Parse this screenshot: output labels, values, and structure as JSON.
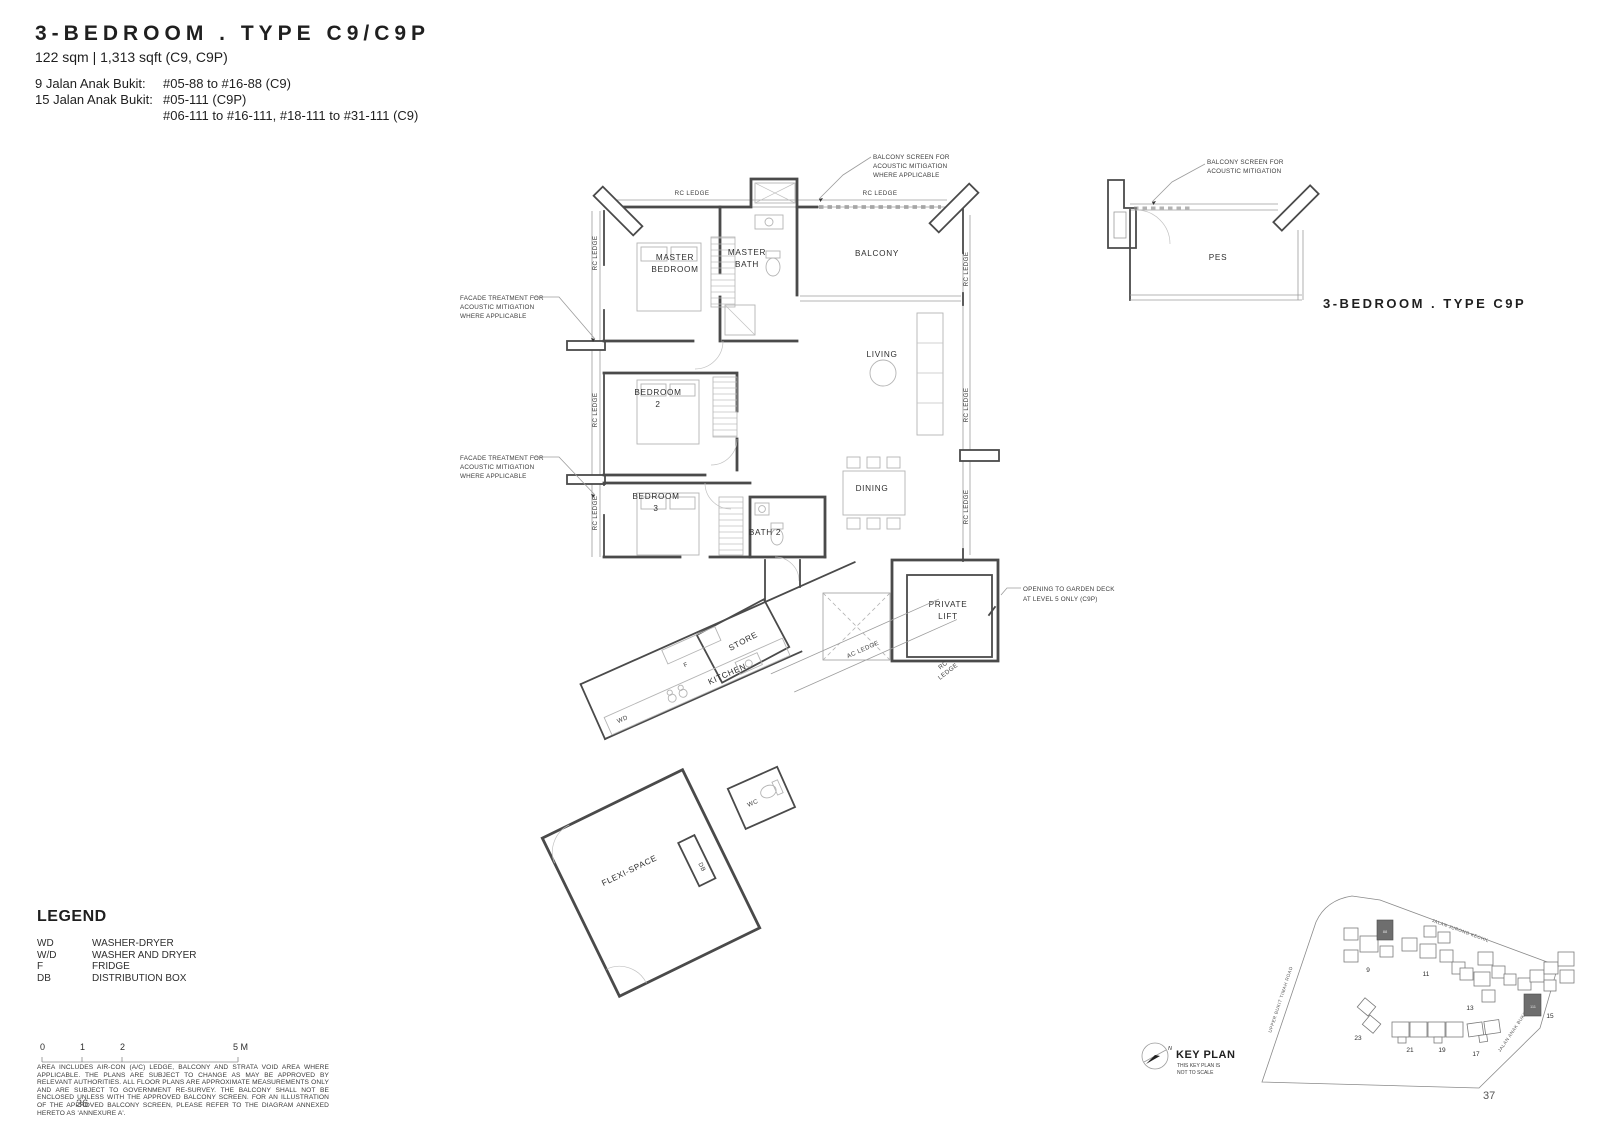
{
  "header": {
    "title": "3-BEDROOM . TYPE C9/C9P",
    "area": "122 sqm | 1,313 sqft (C9, C9P)",
    "addresses": [
      {
        "label": "9 Jalan Anak Bukit:",
        "value": "#05-88 to #16-88 (C9)"
      },
      {
        "label": "15 Jalan Anak Bukit:",
        "value": "#05-111 (C9P)"
      },
      {
        "label": "",
        "value": "#06-111 to #16-111, #18-111 to #31-111 (C9)"
      }
    ]
  },
  "plan": {
    "rooms": {
      "master_bedroom": [
        "MASTER",
        "BEDROOM"
      ],
      "master_bath": [
        "MASTER",
        "BATH"
      ],
      "balcony": "BALCONY",
      "living": "LIVING",
      "bedroom2": [
        "BEDROOM",
        "2"
      ],
      "bedroom3": [
        "BEDROOM",
        "3"
      ],
      "bath2": "BATH 2",
      "dining": "DINING",
      "private_lift": [
        "PRIVATE",
        "LIFT"
      ],
      "store": "STORE",
      "kitchen": "KITCHEN",
      "wc": "WC",
      "flexi_space": "FLEXI-SPACE"
    },
    "fixtures": {
      "wd": "WD",
      "f": "F",
      "db": "DB"
    },
    "ledges": {
      "rc": "RC LEDGE",
      "ac": "AC LEDGE",
      "rc_split": [
        "RC",
        "LEDGE"
      ]
    },
    "notes": {
      "balcony_screen": [
        "BALCONY SCREEN FOR",
        "ACOUSTIC MITIGATION",
        "WHERE APPLICABLE"
      ],
      "facade": [
        "FACADE TREATMENT FOR",
        "ACOUSTIC MITIGATION",
        "WHERE APPLICABLE"
      ],
      "garden_deck": [
        "OPENING TO GARDEN DECK",
        "AT LEVEL 5 ONLY (C9P)"
      ]
    }
  },
  "pes_plan": {
    "room": "PES",
    "note": [
      "BALCONY SCREEN FOR",
      "ACOUSTIC MITIGATION"
    ],
    "type_label": "3-BEDROOM . TYPE C9P"
  },
  "legend": {
    "heading": "LEGEND",
    "items": [
      {
        "abbr": "WD",
        "desc": "WASHER-DRYER"
      },
      {
        "abbr": "W/D",
        "desc": "WASHER AND DRYER"
      },
      {
        "abbr": "F",
        "desc": "FRIDGE"
      },
      {
        "abbr": "DB",
        "desc": "DISTRIBUTION BOX"
      }
    ]
  },
  "scale": {
    "ticks": [
      "0",
      "1",
      "2",
      "5 M"
    ]
  },
  "disclaimer": "AREA INCLUDES AIR-CON (A/C) LEDGE, BALCONY AND STRATA VOID AREA WHERE APPLICABLE. THE PLANS ARE SUBJECT TO CHANGE AS MAY BE APPROVED BY RELEVANT AUTHORITIES. ALL FLOOR PLANS ARE APPROXIMATE MEASUREMENTS ONLY AND ARE SUBJECT TO GOVERNMENT RE-SURVEY. THE BALCONY SHALL NOT BE ENCLOSED UNLESS WITH THE APPROVED BALCONY SCREEN. FOR AN ILLUSTRATION OF THE APPROVED BALCONY SCREEN, PLEASE REFER TO THE DIAGRAM ANNEXED HERETO AS 'ANNEXURE A'.",
  "key_plan": {
    "title": "KEY PLAN",
    "note": [
      "THIS KEY PLAN IS",
      "NOT TO SCALE"
    ],
    "roads": [
      "JALAN JURONG KECHIL",
      "UPPER BUKIT TIMAH ROAD",
      "JALAN ANAK BUKIT"
    ],
    "towers": [
      "9",
      "11",
      "13",
      "15",
      "23",
      "21",
      "19",
      "17"
    ],
    "highlighted_units": [
      "88",
      "111"
    ],
    "north": "N"
  },
  "page": {
    "left_number": "36",
    "right_number": "37"
  }
}
